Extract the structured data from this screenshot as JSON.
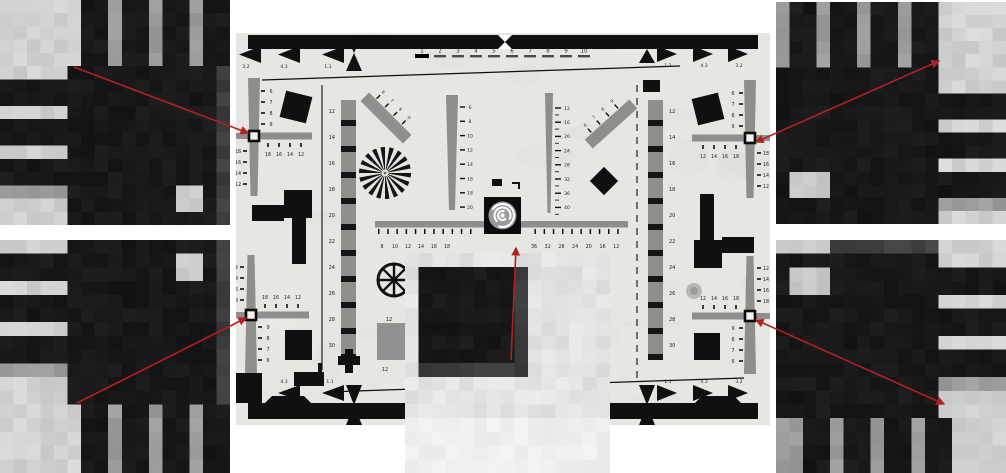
{
  "figure": {
    "colors": {
      "paper": "#e6e6e2",
      "ink": "#101010",
      "gray": "#8e8e8c",
      "red": "#b22020",
      "marker_white": "#f2f2f0",
      "crop_palette": {
        "light": "#d2d2d2",
        "light2": "#e3e3e3",
        "lighter": "#efefef",
        "mid": "#9c9c9c",
        "dark": "#181818",
        "dim": "#3e3e3e",
        "hole": "#c9c9c9"
      }
    },
    "chart": {
      "x": 236,
      "y": 33,
      "w": 534,
      "h": 392,
      "top_scale": [
        "1",
        "2",
        "3",
        "4",
        "5",
        "6",
        "7",
        "8",
        "9",
        "10"
      ],
      "aspect_labels": {
        "top_left": [
          "3.2",
          "4.3",
          "1.1"
        ],
        "top_right": [
          "1.1",
          "4.3",
          "3.2"
        ],
        "bottom_left": [
          "3.2",
          "4.3",
          "1.1"
        ],
        "bottom_right": [
          "1.1",
          "4.3",
          "3.2"
        ]
      },
      "cross_labels": {
        "outer": [
          "6",
          "7",
          "8",
          "9"
        ],
        "inner": [
          "18",
          "16",
          "14",
          "12"
        ],
        "horizontal": [
          "18",
          "16",
          "14",
          "12"
        ]
      },
      "ladder_labels": [
        "12",
        "14",
        "16",
        "18",
        "20",
        "22",
        "24",
        "26",
        "28",
        "30"
      ],
      "ruler_labels_left": [
        "8",
        "10",
        "12",
        "14",
        "16",
        "18"
      ],
      "ruler_labels_right": [
        "36",
        "32",
        "28",
        "24",
        "20",
        "16",
        "12"
      ],
      "wedge_left_labels": [
        "6",
        "8",
        "10",
        "12",
        "14",
        "16",
        "18",
        "20"
      ],
      "wedge_right_labels": [
        "12",
        "16",
        "20",
        "24",
        "28",
        "32",
        "36",
        "40"
      ],
      "diag_labels": [
        "6",
        "7",
        "8",
        "9"
      ],
      "patch_labels": {
        "top": "12",
        "bottom": "12"
      }
    },
    "crops": {
      "items": [
        {
          "id": "top-left",
          "x": 0,
          "y": 0,
          "w": 230,
          "h": 225,
          "cols": 17,
          "rows": 17,
          "bg": "light",
          "seed": 11,
          "rects": [
            {
              "x": 6,
              "y": 0,
              "w": 11,
              "h": 5,
              "c": "mid"
            },
            {
              "x": 6,
              "y": 0,
              "w": 2,
              "h": 5,
              "c": "dark"
            },
            {
              "x": 9,
              "y": 0,
              "w": 2,
              "h": 5,
              "c": "dark"
            },
            {
              "x": 12,
              "y": 0,
              "w": 2,
              "h": 5,
              "c": "dark"
            },
            {
              "x": 15,
              "y": 0,
              "w": 2,
              "h": 5,
              "c": "dark"
            },
            {
              "x": 5,
              "y": 5,
              "w": 12,
              "h": 12,
              "c": "dark"
            },
            {
              "x": 16,
              "y": 5,
              "w": 1,
              "h": 12,
              "c": "dim"
            },
            {
              "x": 0,
              "y": 6,
              "w": 5,
              "h": 2,
              "c": "dark"
            },
            {
              "x": 0,
              "y": 9,
              "w": 5,
              "h": 2,
              "c": "dark"
            },
            {
              "x": 0,
              "y": 12,
              "w": 5,
              "h": 2,
              "c": "dark"
            },
            {
              "x": 0,
              "y": 14,
              "w": 5,
              "h": 1,
              "c": "mid"
            },
            {
              "x": 13,
              "y": 14,
              "w": 2,
              "h": 2,
              "c": "hole"
            }
          ]
        },
        {
          "id": "bottom-left",
          "x": 0,
          "y": 240,
          "w": 230,
          "h": 233,
          "cols": 17,
          "rows": 17,
          "bg": "light",
          "seed": 23,
          "rects": [
            {
              "x": 6,
              "y": 12,
              "w": 11,
              "h": 5,
              "c": "mid"
            },
            {
              "x": 6,
              "y": 12,
              "w": 2,
              "h": 5,
              "c": "dark"
            },
            {
              "x": 9,
              "y": 12,
              "w": 2,
              "h": 5,
              "c": "dark"
            },
            {
              "x": 12,
              "y": 12,
              "w": 2,
              "h": 5,
              "c": "dark"
            },
            {
              "x": 15,
              "y": 12,
              "w": 2,
              "h": 5,
              "c": "dark"
            },
            {
              "x": 5,
              "y": 0,
              "w": 12,
              "h": 12,
              "c": "dark"
            },
            {
              "x": 16,
              "y": 0,
              "w": 1,
              "h": 12,
              "c": "dim"
            },
            {
              "x": 0,
              "y": 1,
              "w": 5,
              "h": 2,
              "c": "dark"
            },
            {
              "x": 0,
              "y": 4,
              "w": 5,
              "h": 2,
              "c": "dark"
            },
            {
              "x": 0,
              "y": 7,
              "w": 5,
              "h": 2,
              "c": "dark"
            },
            {
              "x": 0,
              "y": 9,
              "w": 5,
              "h": 1,
              "c": "mid"
            },
            {
              "x": 13,
              "y": 1,
              "w": 2,
              "h": 2,
              "c": "hole"
            }
          ]
        },
        {
          "id": "top-right",
          "x": 776,
          "y": 2,
          "w": 230,
          "h": 222,
          "cols": 17,
          "rows": 17,
          "bg": "light",
          "seed": 37,
          "rects": [
            {
              "x": 0,
              "y": 0,
              "w": 12,
              "h": 5,
              "c": "mid"
            },
            {
              "x": 1,
              "y": 0,
              "w": 2,
              "h": 5,
              "c": "dark"
            },
            {
              "x": 4,
              "y": 0,
              "w": 2,
              "h": 5,
              "c": "dark"
            },
            {
              "x": 7,
              "y": 0,
              "w": 2,
              "h": 5,
              "c": "dark"
            },
            {
              "x": 10,
              "y": 0,
              "w": 2,
              "h": 5,
              "c": "dark"
            },
            {
              "x": 0,
              "y": 5,
              "w": 12,
              "h": 12,
              "c": "dark"
            },
            {
              "x": 12,
              "y": 7,
              "w": 5,
              "h": 2,
              "c": "dark"
            },
            {
              "x": 12,
              "y": 10,
              "w": 5,
              "h": 2,
              "c": "dark"
            },
            {
              "x": 12,
              "y": 13,
              "w": 5,
              "h": 2,
              "c": "dark"
            },
            {
              "x": 12,
              "y": 15,
              "w": 5,
              "h": 1,
              "c": "mid"
            },
            {
              "x": 1,
              "y": 13,
              "w": 3,
              "h": 2,
              "c": "hole"
            }
          ]
        },
        {
          "id": "bottom-right",
          "x": 776,
          "y": 240,
          "w": 230,
          "h": 233,
          "cols": 17,
          "rows": 17,
          "bg": "light",
          "seed": 51,
          "rects": [
            {
              "x": 0,
              "y": 13,
              "w": 13,
              "h": 4,
              "c": "mid"
            },
            {
              "x": 2,
              "y": 13,
              "w": 2,
              "h": 4,
              "c": "dark"
            },
            {
              "x": 5,
              "y": 13,
              "w": 2,
              "h": 4,
              "c": "dark"
            },
            {
              "x": 8,
              "y": 13,
              "w": 2,
              "h": 4,
              "c": "dark"
            },
            {
              "x": 11,
              "y": 13,
              "w": 2,
              "h": 4,
              "c": "dark"
            },
            {
              "x": 0,
              "y": 1,
              "w": 12,
              "h": 12,
              "c": "dark"
            },
            {
              "x": 4,
              "y": 0,
              "w": 8,
              "h": 1,
              "c": "dim"
            },
            {
              "x": 12,
              "y": 2,
              "w": 5,
              "h": 2,
              "c": "dark"
            },
            {
              "x": 12,
              "y": 5,
              "w": 5,
              "h": 2,
              "c": "dark"
            },
            {
              "x": 12,
              "y": 8,
              "w": 5,
              "h": 2,
              "c": "dark"
            },
            {
              "x": 12,
              "y": 10,
              "w": 5,
              "h": 1,
              "c": "mid"
            },
            {
              "x": 1,
              "y": 2,
              "w": 3,
              "h": 2,
              "c": "hole"
            }
          ]
        },
        {
          "id": "center",
          "x": 405,
          "y": 253,
          "w": 205,
          "h": 220,
          "cols": 15,
          "rows": 16,
          "bg": "light2",
          "seed": 77,
          "rects": [
            {
              "x": 1,
              "y": 1,
              "w": 8,
              "h": 8,
              "c": "dim"
            },
            {
              "x": 1,
              "y": 1,
              "w": 7,
              "h": 7,
              "c": "dark"
            },
            {
              "x": 0,
              "y": 12,
              "w": 15,
              "h": 4,
              "c": "lighter"
            }
          ]
        }
      ]
    },
    "arrows": [
      {
        "x1": 74,
        "y1": 67,
        "x2": 248,
        "y2": 133,
        "head_start": false,
        "head_end": true
      },
      {
        "x1": 77,
        "y1": 403,
        "x2": 246,
        "y2": 318,
        "head_start": false,
        "head_end": true
      },
      {
        "x1": 756,
        "y1": 142,
        "x2": 939,
        "y2": 61,
        "head_start": true,
        "head_end": true
      },
      {
        "x1": 756,
        "y1": 320,
        "x2": 944,
        "y2": 404,
        "head_start": true,
        "head_end": true
      },
      {
        "x1": 511,
        "y1": 360,
        "x2": 516,
        "y2": 248,
        "head_start": false,
        "head_end": true
      }
    ]
  }
}
